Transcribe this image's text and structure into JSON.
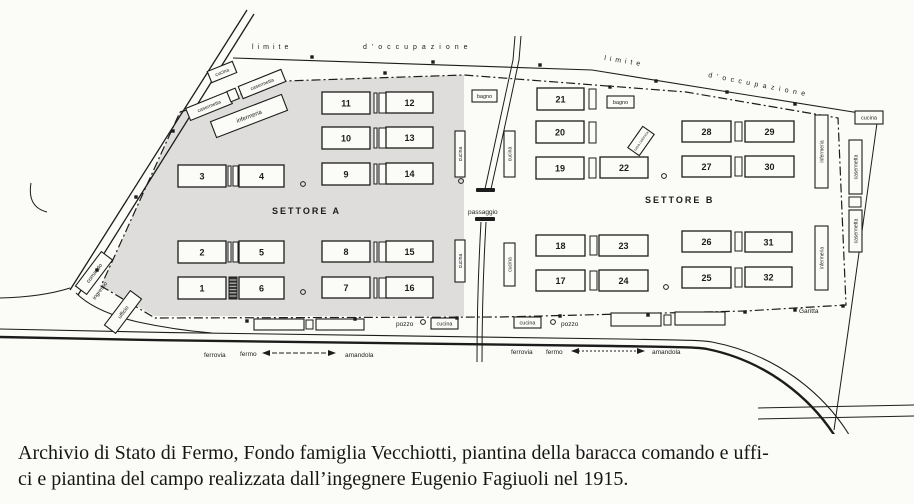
{
  "caption": {
    "line1": "Archivio di Stato di Fermo, Fondo famiglia Vecchiotti, piantina della baracca comando e uffi-",
    "line2": "ci e piantina del campo realizzata dall’ingegnere Eugenio Fagiuoli nel 1915."
  },
  "map": {
    "colors": {
      "ink": "#1c1c1c",
      "paper": "#fbfbf8",
      "sector_fill": "#dedddb"
    },
    "sector_a_points": "180,112 285,81 464,75 464,316 155,316 101,286",
    "paths": [
      {
        "name": "road-topleft-outer",
        "d": "M 247,10 L 70,290",
        "w": 1.3
      },
      {
        "name": "road-topleft-inner",
        "d": "M 254,14 L 78,295",
        "w": 1.3
      },
      {
        "name": "limit-line-top",
        "d": "M 233,58 L 592,70 L 878,116",
        "w": 1.1
      },
      {
        "name": "camp-boundary-dashdot",
        "d": "M 180,112 L 285,81 L 464,75 L 686,92 L 838,118 L 846,305 L 745,311 L 500,317 L 155,318 L 101,286 L 180,112",
        "w": 1.2,
        "dash": "9 3 2 3"
      },
      {
        "name": "central-road-upper-left",
        "d": "M 515,36 L 513,60 Q 498,130 485,189",
        "w": 1
      },
      {
        "name": "central-road-upper-right",
        "d": "M 521,36 L 519,60 Q 504,131 491,189",
        "w": 1
      },
      {
        "name": "central-road-lower-left",
        "d": "M 481,222 Q 477,292 477,362",
        "w": 1
      },
      {
        "name": "central-road-lower-right",
        "d": "M 486,222 Q 482,292 482,362",
        "w": 1
      },
      {
        "name": "railway-upper-rail",
        "d": "M 0,329 C 220,334 480,338 620,339 C 680,340 700,340 712,342 C 775,354 822,392 848,433 L 858,456",
        "w": 1.1
      },
      {
        "name": "railway-lower-rail",
        "d": "M 0,337 C 220,342 480,345 612,346 C 672,347 696,347 707,349 C 766,361 812,398 838,441 L 847,460",
        "w": 2.4
      },
      {
        "name": "right-edge-line",
        "d": "M 878,116 L 848,332 L 834,430",
        "w": 1
      },
      {
        "name": "road-bottomright-upper",
        "d": "M 758,408 L 914,405",
        "w": 1
      },
      {
        "name": "road-bottomright-lower",
        "d": "M 758,419 L 914,416",
        "w": 1
      },
      {
        "name": "left-hook-curve",
        "d": "M 31,183 Q 27,207 47,212",
        "w": 1
      },
      {
        "name": "entrance-curve-west",
        "d": "M 70,288 Q 42,297 0,298",
        "w": 1
      },
      {
        "name": "entrance-curve-south",
        "d": "M 76,293 Q 95,312 138,322 Q 175,330 212,333",
        "w": 1
      },
      {
        "name": "arrow-ferrovia-left",
        "d": "M 265,353 L 333,353",
        "w": 0.9,
        "dash": "5 2"
      },
      {
        "name": "arrowhead-left-a",
        "d": "M 262,353 l 8,-3 v 6 z",
        "fill": true
      },
      {
        "name": "arrowhead-left-b",
        "d": "M 336,353 l -8,-3 v 6 z",
        "fill": true
      },
      {
        "name": "arrow-ferrovia-right",
        "d": "M 574,351 L 642,351",
        "w": 0.9,
        "dash": "2 2"
      },
      {
        "name": "arrowhead-right-a",
        "d": "M 571,351 l 8,-3 v 6 z",
        "fill": true
      },
      {
        "name": "arrowhead-right-b",
        "d": "M 645,351 l -8,-3 v 6 z",
        "fill": true
      }
    ],
    "numbered_buildings": [
      {
        "n": "1",
        "x": 178,
        "y": 277,
        "w": 48,
        "h": 22
      },
      {
        "n": "2",
        "x": 178,
        "y": 241,
        "w": 48,
        "h": 22
      },
      {
        "n": "3",
        "x": 178,
        "y": 165,
        "w": 48,
        "h": 22
      },
      {
        "n": "4",
        "x": 239,
        "y": 165,
        "w": 45,
        "h": 22
      },
      {
        "n": "5",
        "x": 239,
        "y": 241,
        "w": 45,
        "h": 22
      },
      {
        "n": "6",
        "x": 239,
        "y": 277,
        "w": 45,
        "h": 22
      },
      {
        "n": "7",
        "x": 322,
        "y": 277,
        "w": 48,
        "h": 21
      },
      {
        "n": "8",
        "x": 322,
        "y": 241,
        "w": 48,
        "h": 21
      },
      {
        "n": "9",
        "x": 322,
        "y": 163,
        "w": 48,
        "h": 22
      },
      {
        "n": "10",
        "x": 322,
        "y": 127,
        "w": 48,
        "h": 22
      },
      {
        "n": "11",
        "x": 322,
        "y": 92,
        "w": 48,
        "h": 22
      },
      {
        "n": "12",
        "x": 386,
        "y": 92,
        "w": 47,
        "h": 21
      },
      {
        "n": "13",
        "x": 386,
        "y": 127,
        "w": 47,
        "h": 21
      },
      {
        "n": "14",
        "x": 386,
        "y": 163,
        "w": 47,
        "h": 21
      },
      {
        "n": "15",
        "x": 386,
        "y": 241,
        "w": 47,
        "h": 21
      },
      {
        "n": "16",
        "x": 386,
        "y": 277,
        "w": 47,
        "h": 21
      },
      {
        "n": "17",
        "x": 536,
        "y": 270,
        "w": 49,
        "h": 21
      },
      {
        "n": "18",
        "x": 536,
        "y": 235,
        "w": 49,
        "h": 21
      },
      {
        "n": "19",
        "x": 536,
        "y": 157,
        "w": 48,
        "h": 22
      },
      {
        "n": "20",
        "x": 536,
        "y": 121,
        "w": 48,
        "h": 22
      },
      {
        "n": "21",
        "x": 537,
        "y": 88,
        "w": 47,
        "h": 22
      },
      {
        "n": "22",
        "x": 600,
        "y": 157,
        "w": 48,
        "h": 21
      },
      {
        "n": "23",
        "x": 599,
        "y": 235,
        "w": 49,
        "h": 21
      },
      {
        "n": "24",
        "x": 599,
        "y": 270,
        "w": 49,
        "h": 21
      },
      {
        "n": "25",
        "x": 682,
        "y": 267,
        "w": 49,
        "h": 21
      },
      {
        "n": "26",
        "x": 682,
        "y": 231,
        "w": 49,
        "h": 21
      },
      {
        "n": "27",
        "x": 682,
        "y": 156,
        "w": 49,
        "h": 21
      },
      {
        "n": "28",
        "x": 682,
        "y": 121,
        "w": 49,
        "h": 21
      },
      {
        "n": "29",
        "x": 745,
        "y": 121,
        "w": 49,
        "h": 21
      },
      {
        "n": "30",
        "x": 745,
        "y": 156,
        "w": 49,
        "h": 21
      },
      {
        "n": "31",
        "x": 745,
        "y": 232,
        "w": 47,
        "h": 20
      },
      {
        "n": "32",
        "x": 745,
        "y": 267,
        "w": 47,
        "h": 20
      }
    ],
    "connectors": [
      [
        228,
        166,
        3,
        20
      ],
      [
        233,
        166,
        5,
        20
      ],
      [
        228,
        242,
        3,
        20
      ],
      [
        233,
        242,
        5,
        20
      ],
      [
        229,
        277,
        8,
        22,
        "h"
      ],
      [
        374,
        93,
        3,
        20
      ],
      [
        379,
        93,
        7,
        20
      ],
      [
        374,
        128,
        3,
        20
      ],
      [
        379,
        128,
        7,
        20
      ],
      [
        374,
        164,
        3,
        20
      ],
      [
        379,
        164,
        7,
        20
      ],
      [
        374,
        242,
        3,
        20
      ],
      [
        379,
        242,
        7,
        20
      ],
      [
        374,
        278,
        3,
        20
      ],
      [
        379,
        278,
        7,
        20
      ],
      [
        589,
        89,
        7,
        20
      ],
      [
        589,
        122,
        7,
        21
      ],
      [
        589,
        158,
        7,
        20
      ],
      [
        590,
        236,
        7,
        19
      ],
      [
        590,
        271,
        7,
        19
      ],
      [
        735,
        122,
        7,
        19
      ],
      [
        735,
        157,
        7,
        19
      ],
      [
        735,
        232,
        7,
        19
      ],
      [
        735,
        268,
        7,
        19
      ],
      [
        306,
        320,
        7,
        9
      ],
      [
        664,
        315,
        7,
        10
      ],
      [
        849,
        197,
        12,
        10
      ]
    ],
    "plain_boxes": [
      [
        254,
        319,
        50,
        11
      ],
      [
        316,
        319,
        48,
        11
      ],
      [
        611,
        313,
        50,
        13
      ],
      [
        675,
        312,
        50,
        13
      ]
    ],
    "labeled_boxes": [
      {
        "label": "bagno",
        "x": 472,
        "y": 90,
        "w": 25,
        "h": 12
      },
      {
        "label": "bagno",
        "x": 607,
        "y": 96,
        "w": 27,
        "h": 12
      },
      {
        "label": "cucina",
        "x": 855,
        "y": 111,
        "w": 28,
        "h": 13
      },
      {
        "label": "cucina",
        "x": 431,
        "y": 318,
        "w": 27,
        "h": 11
      },
      {
        "label": "cucina",
        "x": 514,
        "y": 317,
        "w": 27,
        "h": 11
      }
    ],
    "vertical_boxes": [
      {
        "label": "cucina",
        "x": 455,
        "y": 131,
        "w": 10,
        "h": 46
      },
      {
        "label": "cucina",
        "x": 455,
        "y": 240,
        "w": 10,
        "h": 42
      },
      {
        "label": "cucina",
        "x": 504,
        "y": 131,
        "w": 11,
        "h": 46
      },
      {
        "label": "cucina",
        "x": 504,
        "y": 243,
        "w": 11,
        "h": 43
      },
      {
        "label": "infermeria",
        "x": 815,
        "y": 115,
        "w": 13,
        "h": 73
      },
      {
        "label": "infermeria",
        "x": 815,
        "y": 226,
        "w": 13,
        "h": 64
      },
      {
        "label": "casermetta",
        "x": 849,
        "y": 140,
        "w": 13,
        "h": 54
      },
      {
        "label": "casermetta",
        "x": 849,
        "y": 210,
        "w": 13,
        "h": 42
      }
    ],
    "tilted_boxes": [
      {
        "label": "cucina",
        "cx": 222,
        "cy": 72,
        "w": 27,
        "h": 12,
        "rot": -22,
        "fs": 5
      },
      {
        "label": "casermetta",
        "cx": 209,
        "cy": 106,
        "w": 45,
        "h": 13,
        "rot": -22,
        "fs": 5
      },
      {
        "label": "",
        "cx": 233,
        "cy": 95,
        "w": 9,
        "h": 11,
        "rot": -22,
        "fs": 5
      },
      {
        "label": "casermetta",
        "cx": 262,
        "cy": 84,
        "w": 46,
        "h": 13,
        "rot": -22,
        "fs": 5
      },
      {
        "label": "infermeria",
        "cx": 249,
        "cy": 116,
        "w": 76,
        "h": 17,
        "rot": -21,
        "fs": 6
      },
      {
        "label": "comando",
        "cx": 94,
        "cy": 273,
        "w": 43,
        "h": 14,
        "rot": -53,
        "fs": 5.5
      },
      {
        "label": "ufficio",
        "cx": 123,
        "cy": 312,
        "w": 43,
        "h": 14,
        "rot": -53,
        "fs": 5.5
      },
      {
        "label": "casa colonica",
        "cx": 641,
        "cy": 141,
        "w": 26,
        "h": 14,
        "rot": -55,
        "fs": 3.8
      }
    ],
    "squares": [
      [
        312,
        57
      ],
      [
        433,
        62
      ],
      [
        540,
        65
      ],
      [
        656,
        81
      ],
      [
        727,
        92
      ],
      [
        795,
        104
      ],
      [
        385,
        73
      ],
      [
        610,
        87
      ],
      [
        247,
        321
      ],
      [
        355,
        319
      ],
      [
        457,
        318
      ],
      [
        560,
        316
      ],
      [
        648,
        315
      ],
      [
        745,
        312
      ],
      [
        795,
        310
      ],
      [
        843,
        306
      ],
      [
        173,
        131
      ],
      [
        136,
        197
      ],
      [
        97,
        270
      ]
    ],
    "bars": [
      [
        476,
        188,
        19,
        4
      ],
      [
        475,
        217,
        20,
        4
      ]
    ],
    "circles": [
      [
        303,
        184
      ],
      [
        461,
        181
      ],
      [
        303,
        292
      ],
      [
        664,
        176
      ],
      [
        666,
        287
      ],
      [
        423,
        322
      ],
      [
        553,
        322
      ]
    ],
    "texts": [
      {
        "t": "limite",
        "x": 252,
        "y": 49,
        "fs": 7,
        "ls": 4
      },
      {
        "t": "d'occupazione",
        "x": 363,
        "y": 49,
        "fs": 7,
        "ls": 5
      },
      {
        "t": "limite",
        "x": 604,
        "y": 60,
        "fs": 7,
        "ls": 4,
        "rot": 9
      },
      {
        "t": "d'occupazione",
        "x": 708,
        "y": 77,
        "fs": 7,
        "ls": 4.5,
        "rot": 11
      },
      {
        "t": "SETTORE  A",
        "x": 272,
        "y": 214,
        "fs": 9,
        "ls": 2,
        "bold": true
      },
      {
        "t": "SETTORE  B",
        "x": 645,
        "y": 203,
        "fs": 9,
        "ls": 2,
        "bold": true
      },
      {
        "t": "passaggio",
        "x": 468,
        "y": 214,
        "fs": 6.5
      },
      {
        "t": "pozzo",
        "x": 396,
        "y": 326,
        "fs": 6.5
      },
      {
        "t": "pozzo",
        "x": 561,
        "y": 326,
        "fs": 6.5
      },
      {
        "t": "Garitta",
        "x": 799,
        "y": 313,
        "fs": 6.5
      },
      {
        "t": "ferrovia",
        "x": 204,
        "y": 357,
        "fs": 6.5
      },
      {
        "t": "fermo",
        "x": 240,
        "y": 356,
        "fs": 6.5
      },
      {
        "t": "amandola",
        "x": 345,
        "y": 357,
        "fs": 6.5
      },
      {
        "t": "ferrovia",
        "x": 511,
        "y": 354,
        "fs": 6.5
      },
      {
        "t": "fermo",
        "x": 546,
        "y": 354,
        "fs": 6.5
      },
      {
        "t": "amandola",
        "x": 652,
        "y": 354,
        "fs": 6.5
      },
      {
        "t": "ingresso",
        "x": 95,
        "y": 300,
        "fs": 5.5,
        "rot": -53
      }
    ]
  }
}
